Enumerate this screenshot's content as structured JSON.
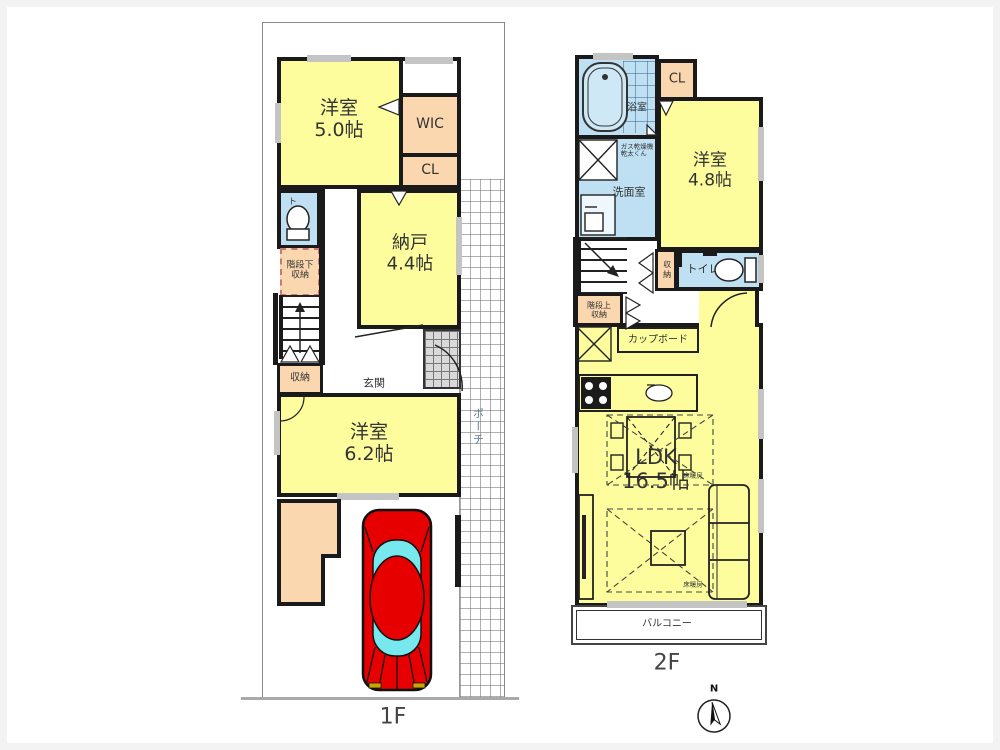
{
  "plan_type": "floor_plan",
  "floor1": {
    "label": "1F",
    "rooms": {
      "yoshitsu5": "洋室\n5.0帖",
      "wic_top": "WIC",
      "cl": "CL",
      "toilet": "トイレ",
      "under_stair_storage": "階段下\n収納",
      "storage": "収納",
      "nando": "納戸\n4.4帖",
      "genkan": "玄関",
      "yoshitsu62": "洋室\n6.2帖",
      "wic_bottom": "WIC",
      "porch": "ポーチ"
    }
  },
  "floor2": {
    "label": "2F",
    "rooms": {
      "bath": "浴室",
      "cl": "CL",
      "yoshitsu48": "洋室\n4.8帖",
      "washroom": "洗面室",
      "dryer_note": "ガス乾燥機\n乾太くん",
      "storage": "収納",
      "toilet": "トイレ",
      "over_stair_storage": "階段上\n収納",
      "cupboard": "カップボード",
      "ldk": "LDK\n16.5帖",
      "floor_heating_1": "床暖房",
      "floor_heating_2": "床暖房",
      "balcony": "バルコニー"
    }
  },
  "compass": {
    "north_label": "N"
  },
  "colors": {
    "room_yellow": "#fdfd9e",
    "closet_peach": "#fad7ae",
    "wet_area_blue": "#bfe0f2",
    "wall_black": "#1a1a1a",
    "car_red": "#e60000",
    "car_glass_cyan": "#76e8ee",
    "window_gray": "#c4c4c4"
  }
}
